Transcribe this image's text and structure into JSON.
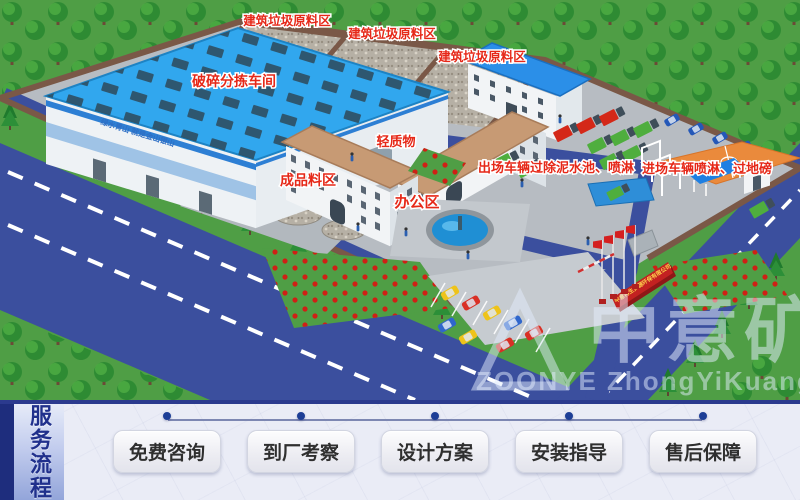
{
  "scene": {
    "area_labels": {
      "raw_area_1": "建筑垃圾原料区",
      "raw_area_2": "建筑垃圾原料区",
      "raw_area_3": "建筑垃圾原料区",
      "crushing_workshop": "破碎分拣车间",
      "light_material": "轻质物",
      "finished_area": "成品料区",
      "office_area": "办公区",
      "exit_wash": "出场车辆过除泥水池、喷淋",
      "entry_wash": "进场车辆喷淋、过地磅"
    },
    "factory_slogan": "绿水青山 就是金山银山",
    "gate_sign": "中意再生资源环保有限公司",
    "watermark": {
      "cn": "中意矿机",
      "en": "ZOONYE ZhongYiKuangji"
    }
  },
  "service_bar": {
    "title": "服务流程",
    "steps": [
      {
        "label": "免费咨询"
      },
      {
        "label": "到厂考察"
      },
      {
        "label": "设计方案"
      },
      {
        "label": "安装指导"
      },
      {
        "label": "售后保障"
      }
    ]
  },
  "colors": {
    "accent_navy": "#1d3e96",
    "label_red": "#e62818",
    "road_blue": "#3b4f9e",
    "roof_blue": "#31a7ee",
    "grass_green": "#4f9e45"
  }
}
